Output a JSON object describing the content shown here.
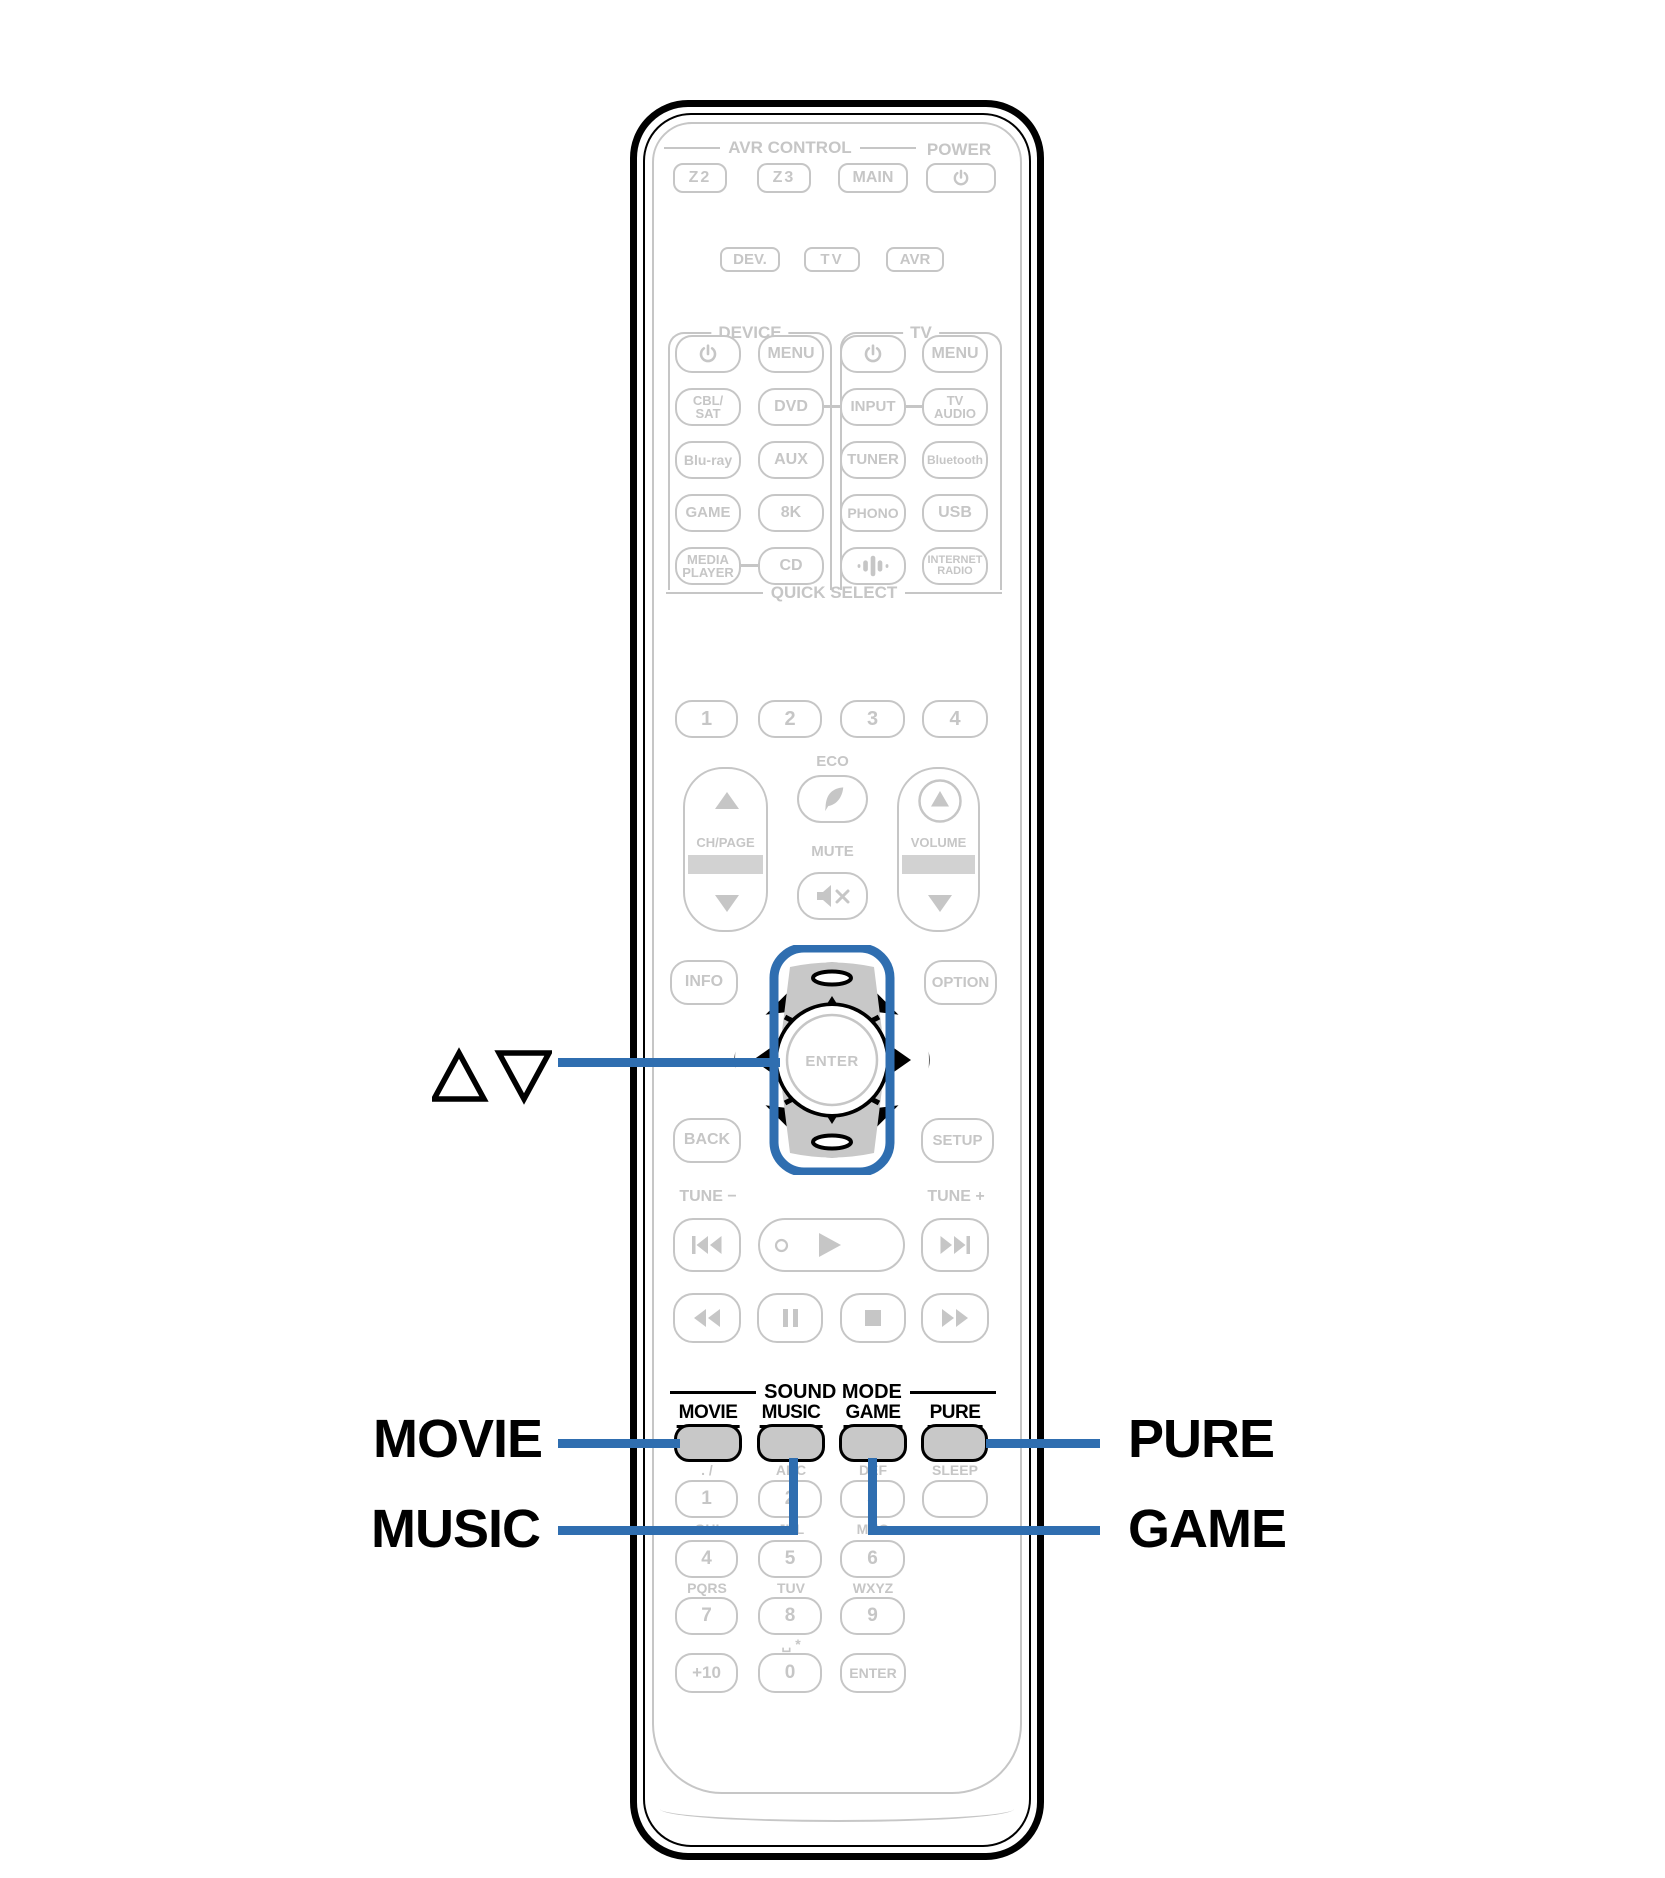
{
  "colors": {
    "line_gray": "#c6c6c6",
    "callout_blue": "#2f6eb0",
    "button_fill": "#c8c8c8",
    "black": "#000000"
  },
  "top": {
    "avr_control_header": "AVR CONTROL",
    "power_header": "POWER",
    "z2": "Z2",
    "z3": "Z3",
    "main": "MAIN"
  },
  "mode_row": {
    "dev": "DEV.",
    "tv": "TV",
    "avr": "AVR"
  },
  "sections": {
    "device": "DEVICE",
    "tv": "TV",
    "quick_select": "QUICK SELECT",
    "eco": "ECO",
    "mute": "MUTE",
    "ch_page": "CH/PAGE",
    "volume": "VOLUME",
    "sound_mode": "SOUND MODE",
    "tune_minus": "TUNE −",
    "tune_plus": "TUNE +"
  },
  "grid": {
    "menu_device": "MENU",
    "menu_tv": "MENU",
    "cbl1": "CBL/",
    "cbl2": "SAT",
    "dvd": "DVD",
    "input": "INPUT",
    "tvaudio1": "TV",
    "tvaudio2": "AUDIO",
    "bluray": "Blu-ray",
    "aux": "AUX",
    "tuner": "TUNER",
    "bluetooth": "Bluetooth",
    "game": "GAME",
    "k8": "8K",
    "phono": "PHONO",
    "usb": "USB",
    "media1": "MEDIA",
    "media2": "PLAYER",
    "cd": "CD",
    "internet1": "INTERNET",
    "internet2": "RADIO"
  },
  "quick_select": {
    "q1": "1",
    "q2": "2",
    "q3": "3",
    "q4": "4"
  },
  "nav": {
    "info": "INFO",
    "option": "OPTION",
    "back": "BACK",
    "setup": "SETUP",
    "enter": "ENTER"
  },
  "sound_mode": {
    "movie": "MOVIE",
    "music": "MUSIC",
    "game": "GAME",
    "pure": "PURE"
  },
  "keypad": {
    "l1": ". /",
    "l2": "ABC",
    "l3": "DEF",
    "sleep": "SLEEP",
    "k1": "1",
    "k2": "2",
    "k3": "3",
    "l4": "GHI",
    "l5": "JKL",
    "l6": "MNO",
    "k4": "4",
    "k5": "5",
    "k6": "6",
    "l7": "PQRS",
    "l8": "TUV",
    "l9": "WXYZ",
    "k7": "7",
    "k8": "8",
    "k9": "9",
    "l0": "␣ *",
    "kplus10": "+10",
    "k0": "0",
    "kenter": "ENTER"
  },
  "callouts": {
    "movie": "MOVIE",
    "music": "MUSIC",
    "pure": "PURE",
    "game": "GAME",
    "cursor_icon": "cursor-up-down-icon"
  }
}
